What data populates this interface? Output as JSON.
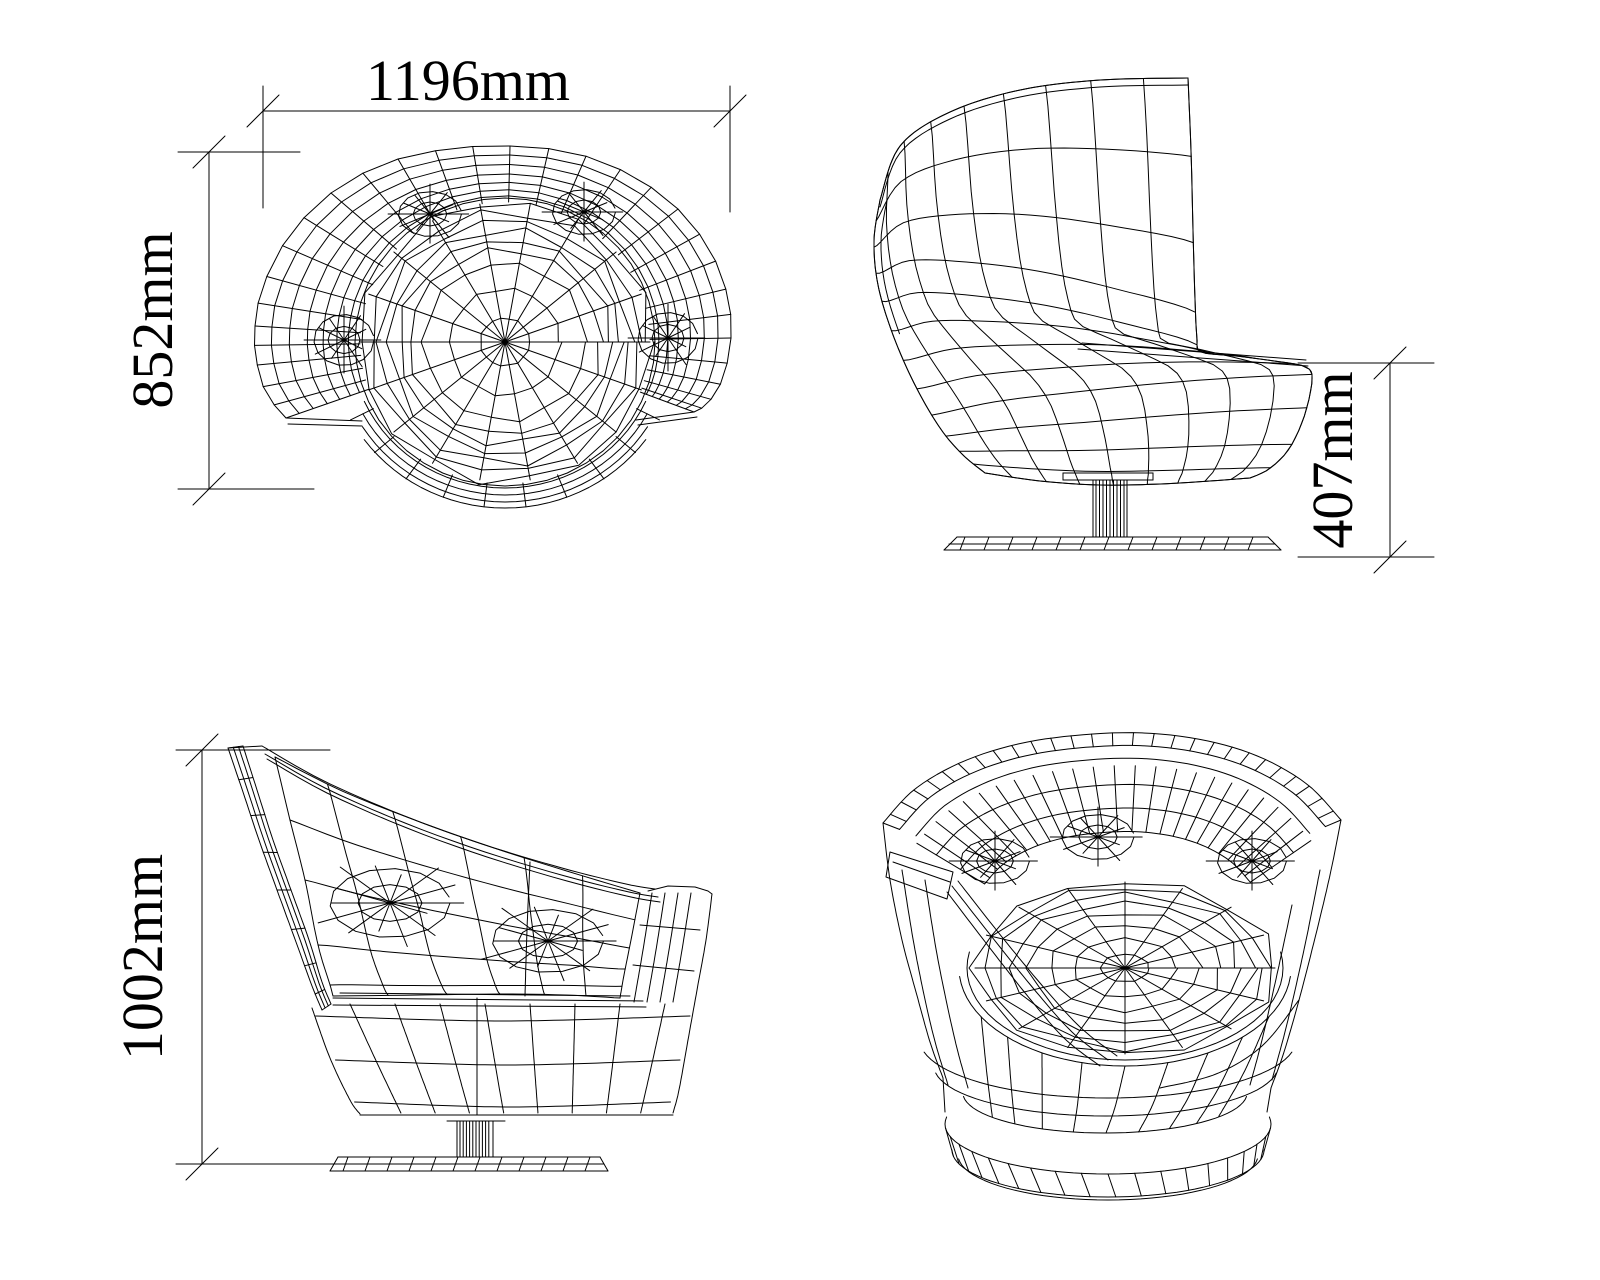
{
  "page": {
    "background_color": "#ffffff",
    "line_color": "#000000"
  },
  "dimensions": {
    "width": "1196mm",
    "depth": "852mm",
    "seat_height": "407mm",
    "overall_height": "1002mm"
  }
}
